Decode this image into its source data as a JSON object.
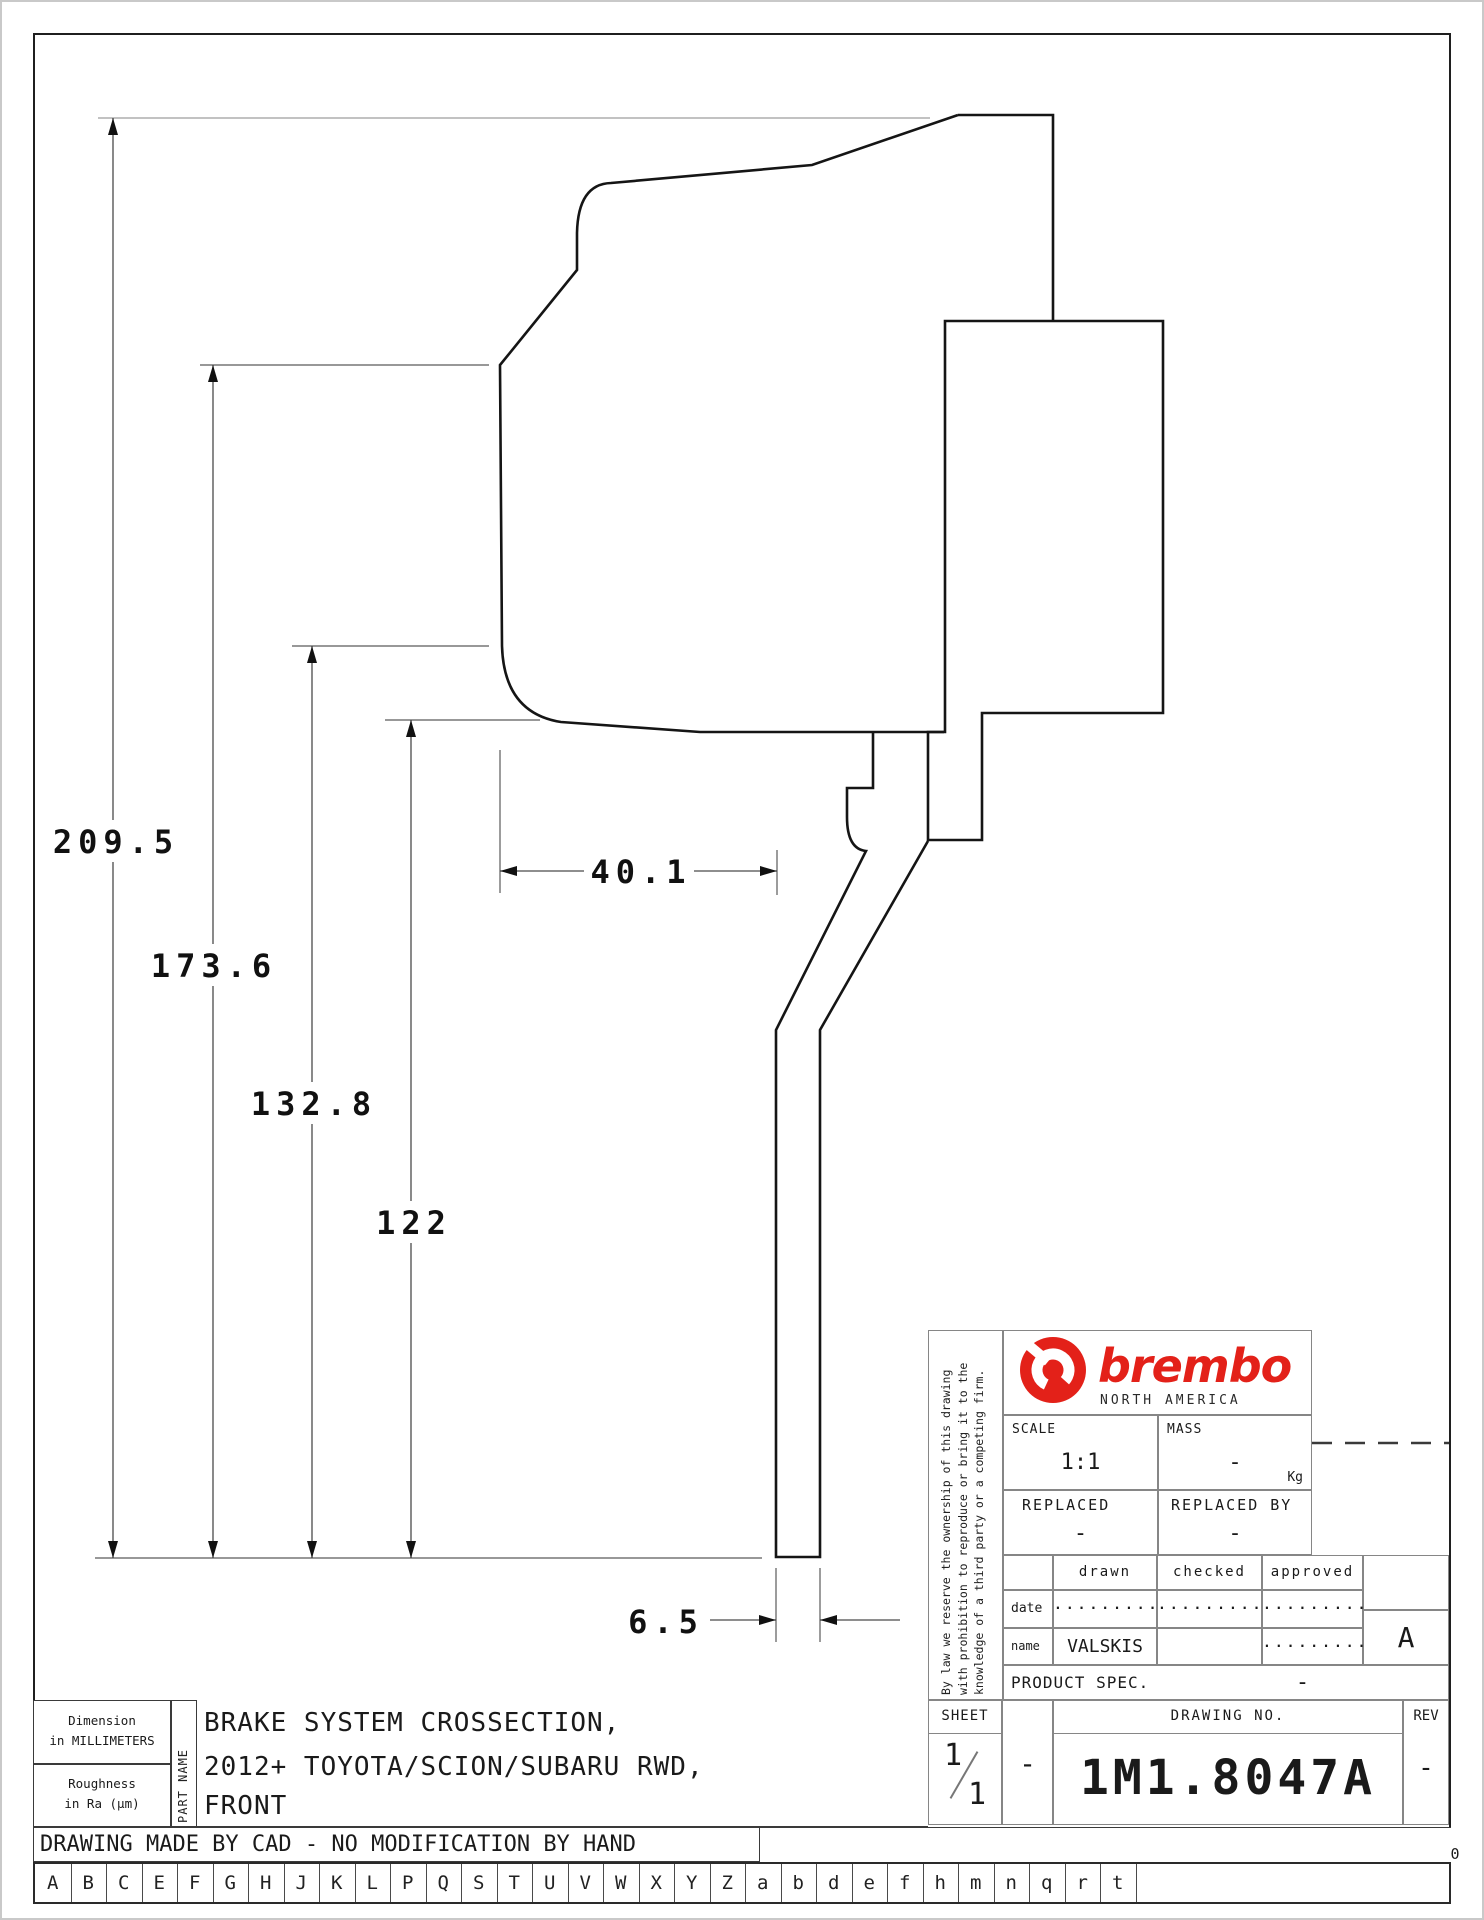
{
  "drawing": {
    "dim_209_5": "209.5",
    "dim_173_6": "173.6",
    "dim_132_8": "132.8",
    "dim_122": "122",
    "dim_40_1": "40.1",
    "dim_6_5": "6.5"
  },
  "title_block": {
    "brand": {
      "name": "brembo",
      "region": "NORTH AMERICA",
      "color": "#e32119"
    },
    "legal": "By law we reserve the ownership of this drawing with prohibition to reproduce or bring it to the knowledge of a third party or a competing firm.",
    "scale_label": "SCALE",
    "scale_value": "1:1",
    "mass_label": "MASS",
    "mass_value": "-",
    "mass_unit": "Kg",
    "replaced_label": "REPLACED",
    "replaced_value": "-",
    "replaced_by_label": "REPLACED BY",
    "replaced_by_value": "-",
    "col_drawn": "drawn",
    "col_checked": "checked",
    "col_approved": "approved",
    "row_date": "date",
    "row_name": "name",
    "date_drawn": ".........",
    "date_checked": ".........",
    "date_approved": ".........",
    "name_drawn": "VALSKIS",
    "name_approved": ".........",
    "product_spec_label": "PRODUCT SPEC.",
    "product_spec_value": "-",
    "sheet_label": "SHEET",
    "sheet_num": "1",
    "sheet_total": "1",
    "sheet_dash": "-",
    "drawing_no_label": "DRAWING NO.",
    "drawing_no": "1M1.8047A",
    "rev_label": "REV",
    "rev_value": "-",
    "zone_marker": "A"
  },
  "footer": {
    "dimension_note_1": "Dimension",
    "dimension_note_2": "in MILLIMETERS",
    "roughness_note_1": "Roughness",
    "roughness_note_2": "in Ra (μm)",
    "part_name_label": "PART NAME",
    "part_name_line1": "BRAKE SYSTEM CROSSECTION,",
    "part_name_line2": "2012+ TOYOTA/SCION/SUBARU RWD,",
    "part_name_line3": "FRONT",
    "cad_note": "DRAWING MADE BY CAD - NO MODIFICATION BY HAND",
    "ruler_numbers": [
      "0",
      "10",
      "20",
      "30",
      "40",
      "50",
      "60",
      "70",
      "80",
      "90",
      "100"
    ],
    "letter_strip": [
      "A",
      "B",
      "C",
      "E",
      "F",
      "G",
      "H",
      "J",
      "K",
      "L",
      "P",
      "Q",
      "S",
      "T",
      "U",
      "V",
      "W",
      "X",
      "Y",
      "Z",
      "a",
      "b",
      "d",
      "e",
      "f",
      "h",
      "m",
      "n",
      "q",
      "r",
      "t"
    ]
  }
}
